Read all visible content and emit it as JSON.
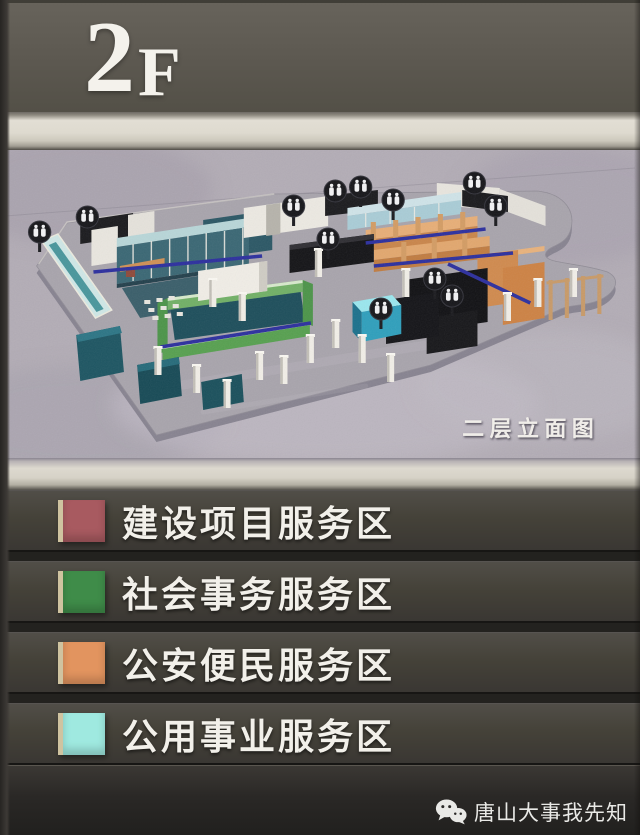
{
  "header": {
    "floor_number": "2",
    "floor_suffix": "F"
  },
  "plan": {
    "caption": "二层立面图",
    "colors": {
      "panel_background": "#b3adb6",
      "floor_plate": "#a8a4ac",
      "glass_teal": "#3a6774",
      "beam_blue": "#2c2f9e",
      "desk_black": "#141417",
      "zone_green": "#57a050",
      "zone_orange": "#d08a4e",
      "zone_cyan": "#2f9fbc"
    }
  },
  "legend": {
    "items": [
      {
        "label": "建设项目服务区",
        "color": "#a85a60"
      },
      {
        "label": "社会事务服务区",
        "color": "#3f8c49"
      },
      {
        "label": "公安便民服务区",
        "color": "#e2945f"
      },
      {
        "label": "公用事业服务区",
        "color": "#9fe9e0"
      }
    ]
  },
  "footer": {
    "watermark_text": "唐山大事我先知",
    "icon": "wechat-icon"
  }
}
